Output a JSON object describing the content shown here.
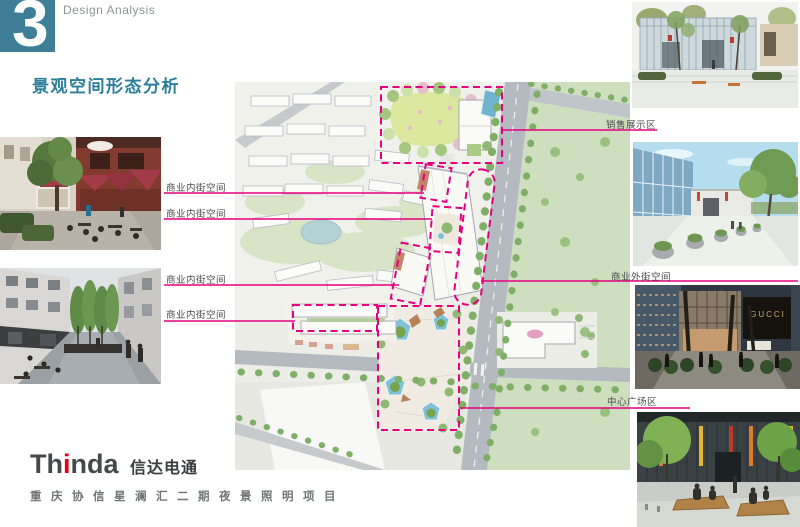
{
  "page": {
    "section_number": "3",
    "section_label": "Design Analysis",
    "title": "景观空间形态分析"
  },
  "annotations": {
    "left": [
      {
        "text": "商业内街空间"
      },
      {
        "text": "商业内街空间"
      },
      {
        "text": "商业内街空间"
      },
      {
        "text": "商业内街空间"
      }
    ],
    "right": [
      {
        "text": "销售展示区"
      },
      {
        "text": "商业外街空间"
      },
      {
        "text": "中心广场区"
      }
    ]
  },
  "photos": {
    "gucci_sign": "GUCCI"
  },
  "footer": {
    "logo_en_1": "Th",
    "logo_en_2": "i",
    "logo_en_3": "nda",
    "logo_cn": "信达电通",
    "project_title": "重庆协信星澜汇二期夜景照明项目"
  },
  "colors": {
    "accent_teal": "#3e7e97",
    "accent_magenta": "#e6007f",
    "logo_red": "#e60012"
  }
}
